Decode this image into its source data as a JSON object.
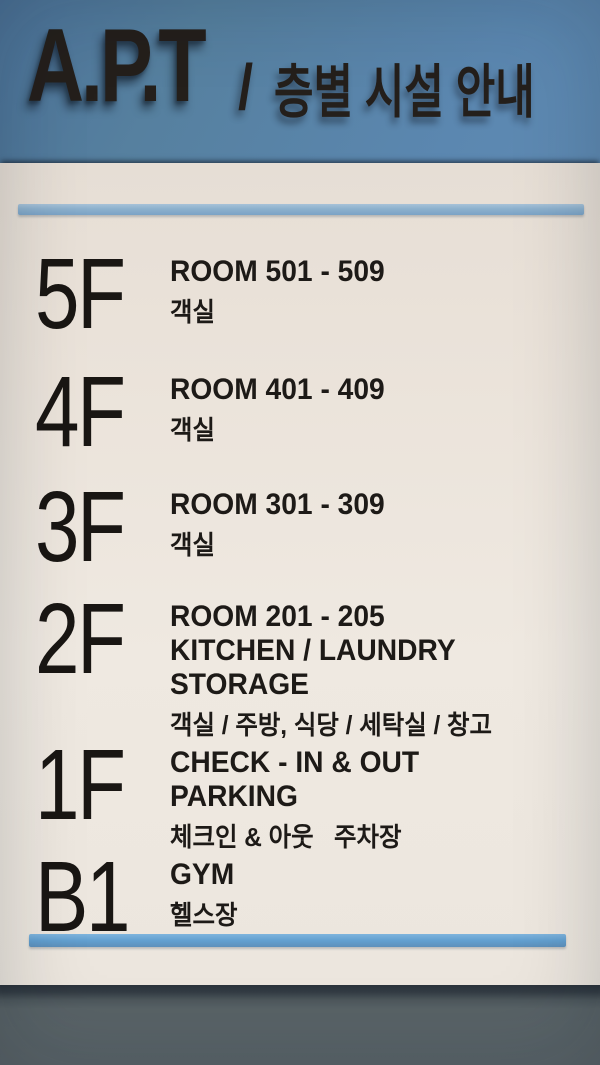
{
  "header": {
    "title": "A.P.T",
    "separator": "/",
    "subtitle_ko": "층별 시설 안내"
  },
  "board": {
    "floors": [
      {
        "floor": "5F",
        "en": [
          "ROOM 501 - 509"
        ],
        "ko": "객실"
      },
      {
        "floor": "4F",
        "en": [
          "ROOM 401 - 409"
        ],
        "ko": "객실"
      },
      {
        "floor": "3F",
        "en": [
          "ROOM 301 - 309"
        ],
        "ko": "객실"
      },
      {
        "floor": "2F",
        "en": [
          "ROOM 201 - 205",
          "KITCHEN / LAUNDRY",
          "STORAGE"
        ],
        "ko": "객실 / 주방, 식당 / 세탁실 / 창고"
      },
      {
        "floor": "1F",
        "en": [
          "CHECK - IN & OUT",
          "PARKING"
        ],
        "ko": "체크인 & 아웃   주차장"
      },
      {
        "floor": "B1",
        "en": [
          "GYM"
        ],
        "ko": "헬스장"
      }
    ]
  },
  "colors": {
    "wall_blue": "#5b87b0",
    "board_cream": "#ece5dc",
    "divider_blue_top": "#8cb0cd",
    "divider_blue_bottom": "#62a0d0",
    "sign_text_dark": "#241f1b",
    "board_text_dark": "#1d1a17",
    "lower_wall_gray": "#5b656a"
  }
}
